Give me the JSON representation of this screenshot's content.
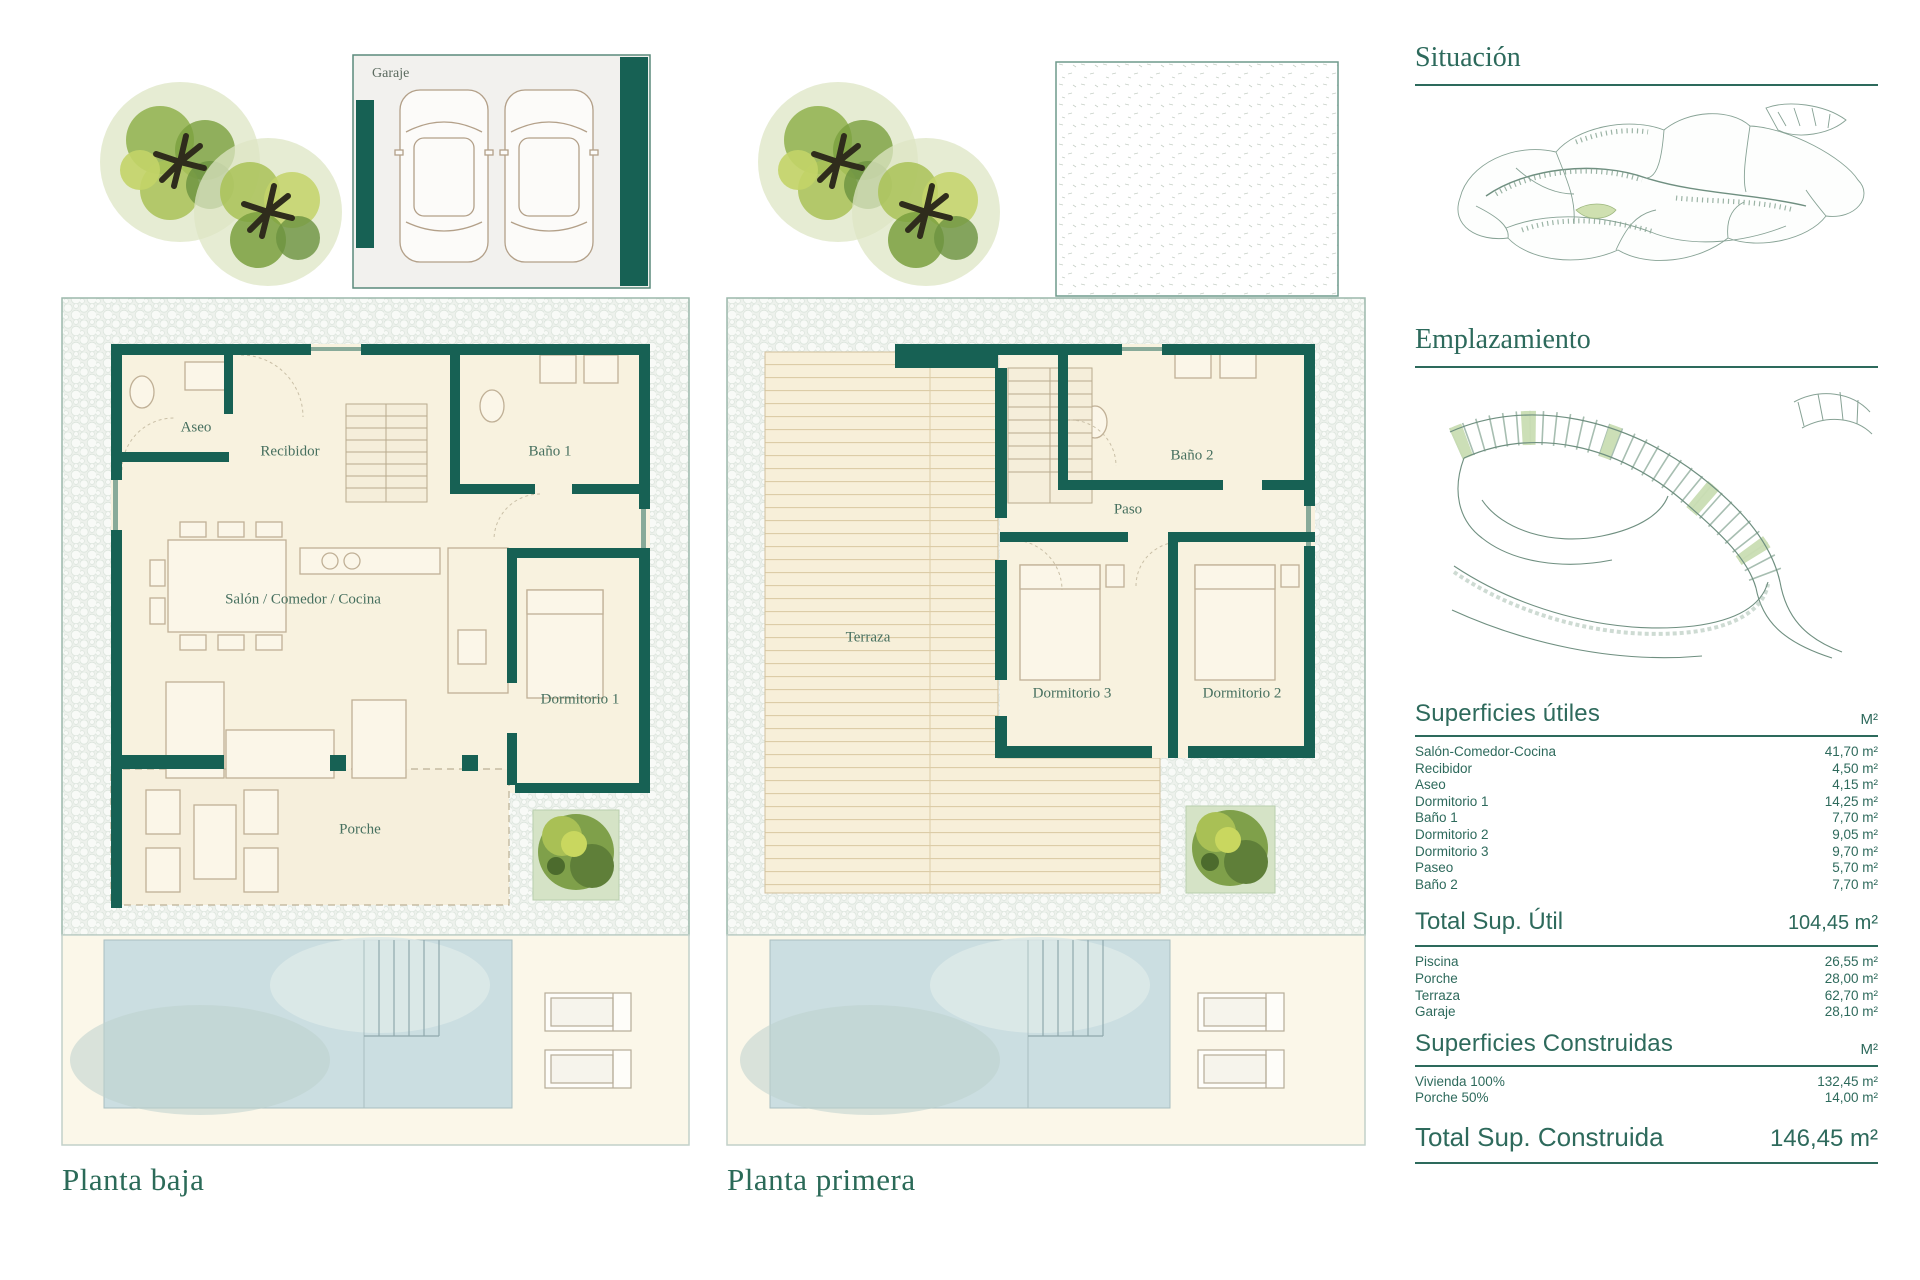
{
  "plans": {
    "baja": {
      "title": "Planta baja",
      "labels": {
        "garaje": "Garaje",
        "aseo": "Aseo",
        "recibidor": "Recibidor",
        "bano1": "Baño 1",
        "salon": "Salón / Comedor / Cocina",
        "dormitorio1": "Dormitorio 1",
        "porche": "Porche"
      }
    },
    "primera": {
      "title": "Planta primera",
      "labels": {
        "terraza": "Terraza",
        "bano2": "Baño 2",
        "paso": "Paso",
        "dormitorio3": "Dormitorio 3",
        "dormitorio2": "Dormitorio 2"
      }
    }
  },
  "sidebar": {
    "situacion_title": "Situación",
    "emplazamiento_title": "Emplazamiento",
    "tables": {
      "utiles": {
        "title": "Superficies útiles",
        "unit": "M²",
        "rows": [
          {
            "label": "Salón-Comedor-Cocina",
            "value": "41,70 m²"
          },
          {
            "label": "Recibidor",
            "value": "4,50 m²"
          },
          {
            "label": "Aseo",
            "value": "4,15 m²"
          },
          {
            "label": "Dormitorio 1",
            "value": "14,25 m²"
          },
          {
            "label": "Baño 1",
            "value": "7,70 m²"
          },
          {
            "label": "Dormitorio 2",
            "value": "9,05 m²"
          },
          {
            "label": "Dormitorio 3",
            "value": "9,70 m²"
          },
          {
            "label": "Paseo",
            "value": "5,70 m²"
          },
          {
            "label": "Baño 2",
            "value": "7,70 m²"
          }
        ]
      },
      "total_util": {
        "label": "Total Sup. Útil",
        "value": "104,45 m²"
      },
      "extras": {
        "rows": [
          {
            "label": "Piscina",
            "value": "26,55 m²"
          },
          {
            "label": "Porche",
            "value": "28,00 m²"
          },
          {
            "label": "Terraza",
            "value": "62,70 m²"
          },
          {
            "label": "Garaje",
            "value": "28,10 m²"
          }
        ]
      },
      "construidas": {
        "title": "Superficies Construidas",
        "unit": "M²",
        "rows": [
          {
            "label": "Vivienda 100%",
            "value": "132,45 m²"
          },
          {
            "label": "Porche 50%",
            "value": "14,00 m²"
          }
        ]
      },
      "total_construida": {
        "label": "Total Sup. Construida",
        "value": "146,45 m²"
      }
    }
  },
  "colors": {
    "wall": "#176154",
    "heading": "#2d6a5c",
    "cream": "#f8f2df",
    "pool": "#cbdee1"
  }
}
